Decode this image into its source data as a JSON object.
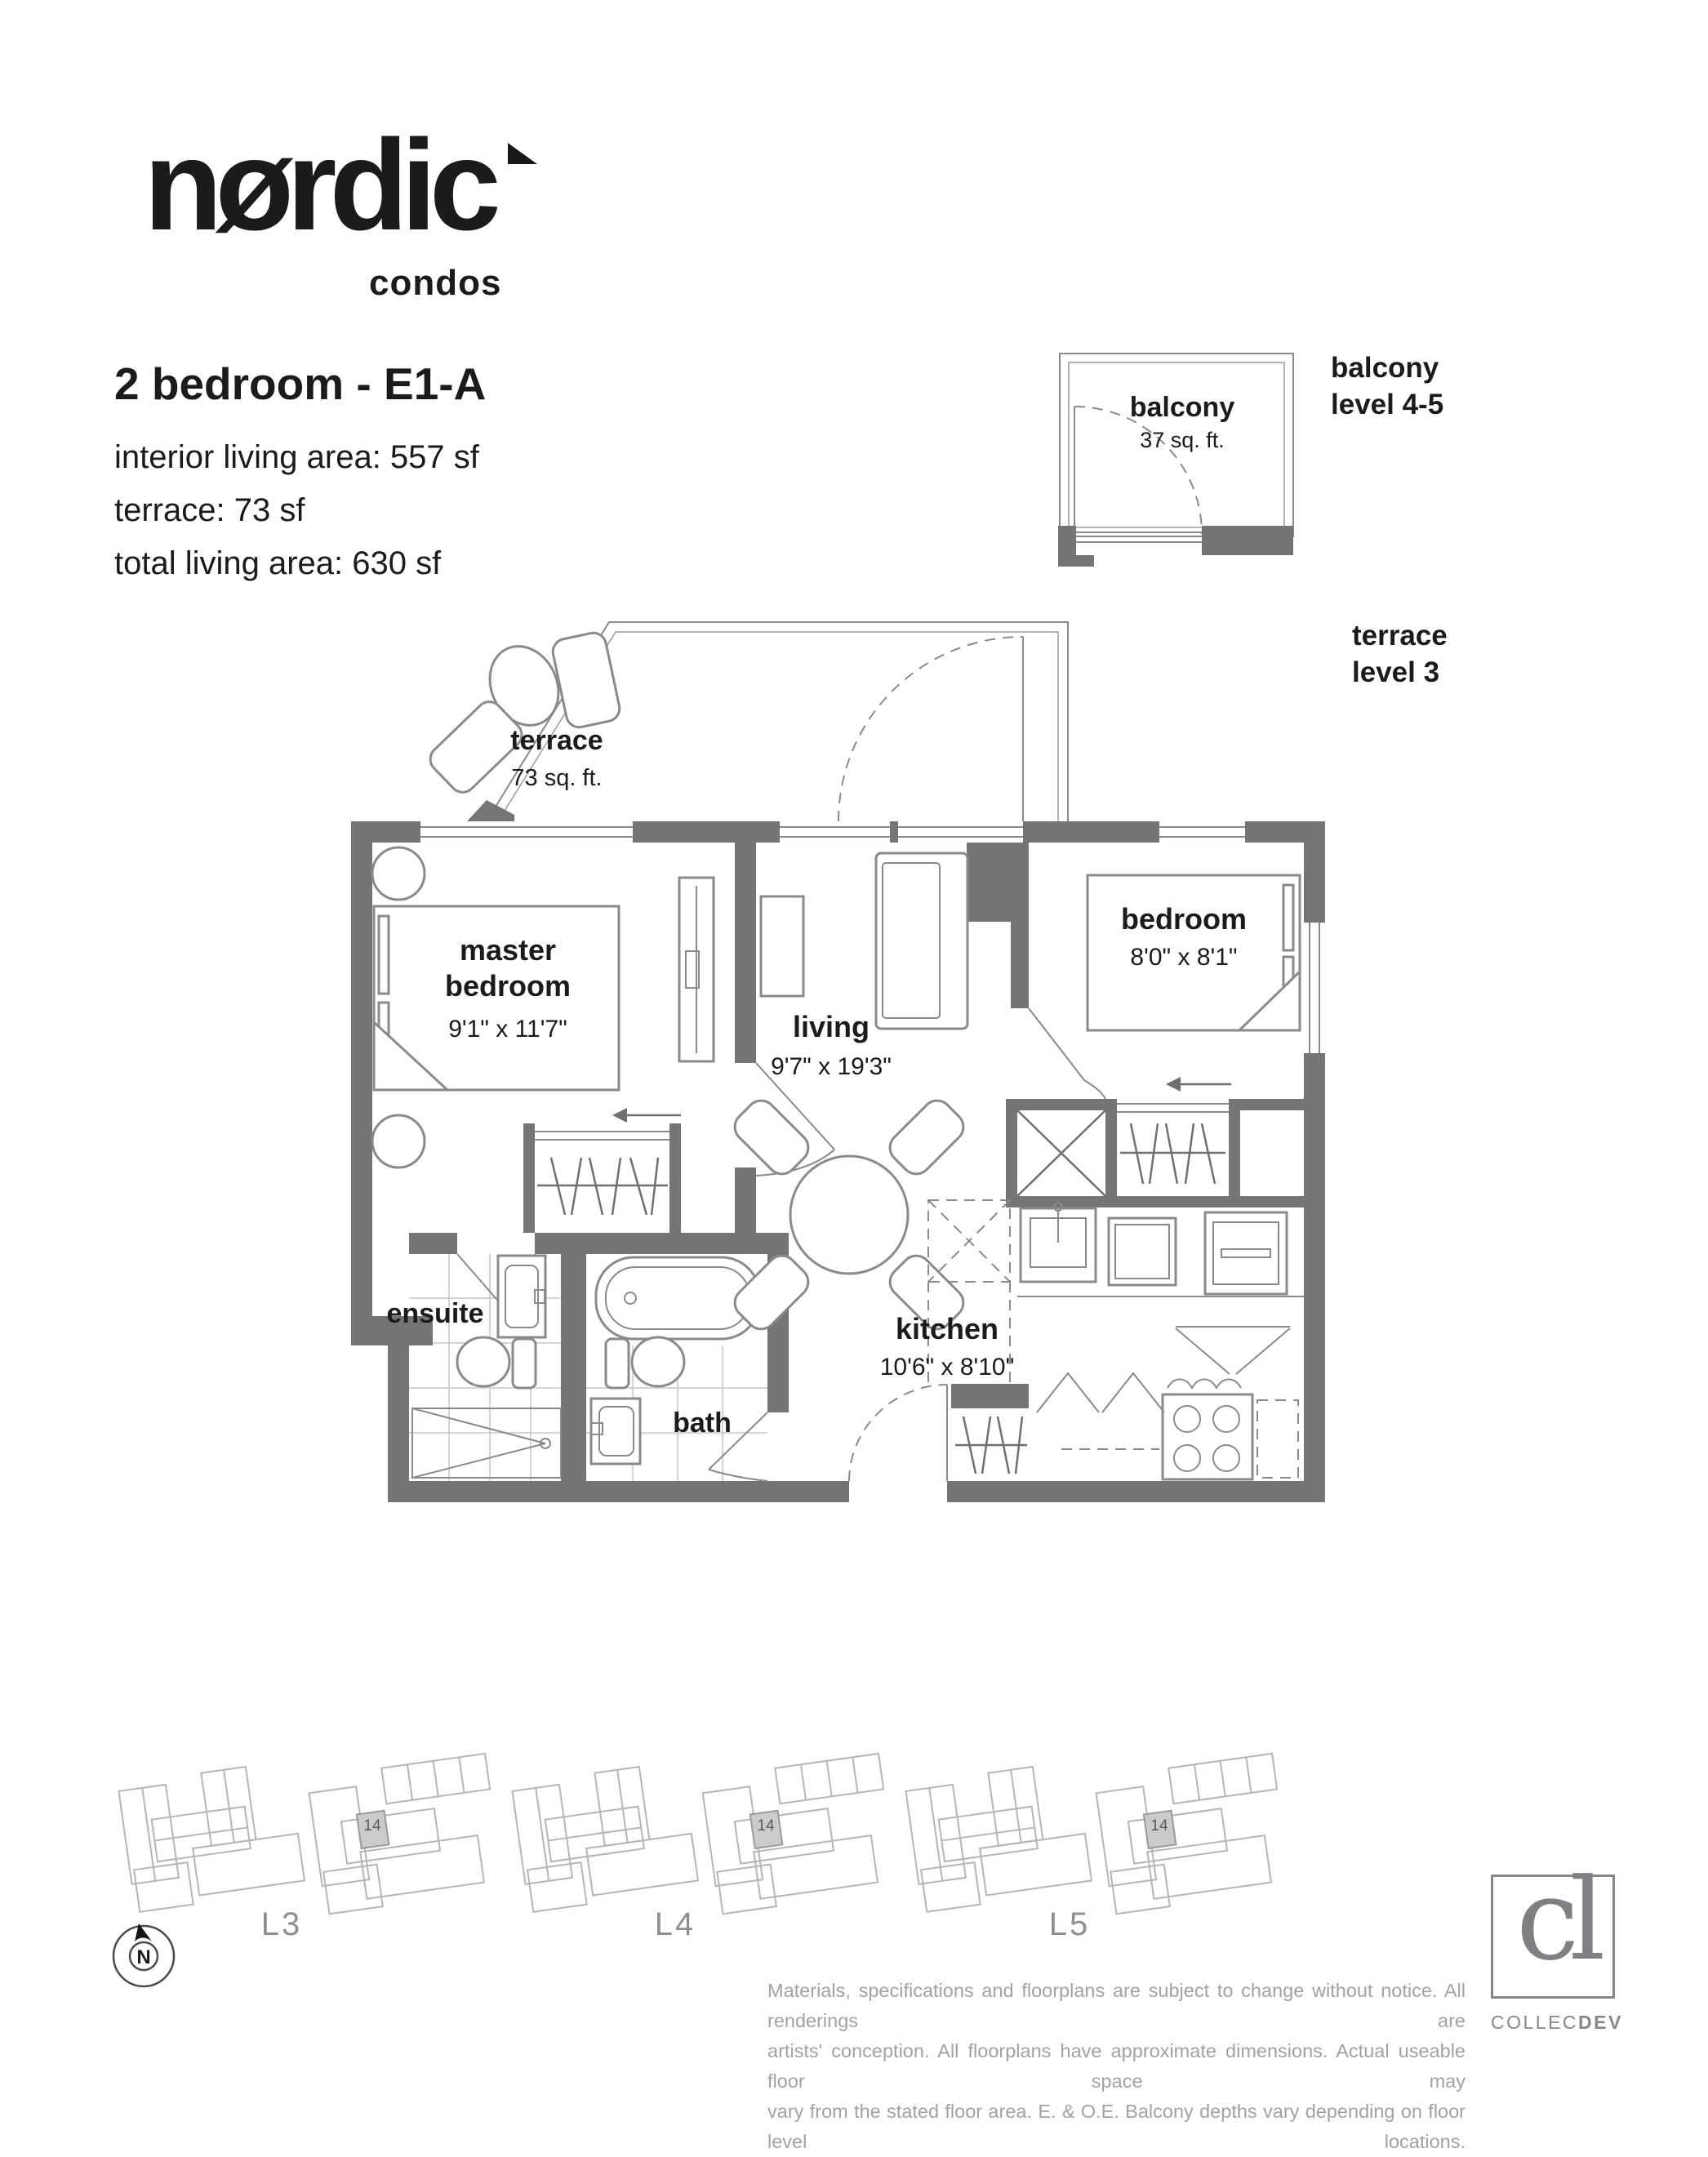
{
  "brand": {
    "logo_text": "nørdic",
    "logo_sub": "condos"
  },
  "header": {
    "title": "2 bedroom - E1-A",
    "area_lines": [
      "interior living area: 557 sf",
      "terrace: 73 sf",
      "total living area: 630 sf"
    ]
  },
  "balcony_inset": {
    "label": "balcony",
    "area": "37 sq. ft.",
    "side_label_line1": "balcony",
    "side_label_line2": "level 4-5"
  },
  "terrace_side_label": {
    "line1": "terrace",
    "line2": "level 3"
  },
  "plan": {
    "rooms": {
      "terrace": {
        "label": "terrace",
        "area": "73 sq. ft."
      },
      "master": {
        "label_line1": "master",
        "label_line2": "bedroom",
        "dims": "9'1\" x 11'7\""
      },
      "bedroom": {
        "label": "bedroom",
        "dims": "8'0\" x 8'1\""
      },
      "living": {
        "label": "living",
        "dims": "9'7\" x 19'3\""
      },
      "kitchen": {
        "label": "kitchen",
        "dims": "10'6\" x 8'10\""
      },
      "ensuite": {
        "label": "ensuite"
      },
      "bath": {
        "label": "bath"
      }
    }
  },
  "keyplans": {
    "items": [
      {
        "label": "L3",
        "unit": "14"
      },
      {
        "label": "L4",
        "unit": "14"
      },
      {
        "label": "L5",
        "unit": "14"
      }
    ]
  },
  "compass": {
    "label": "N"
  },
  "footer": {
    "disclaimer_lines": [
      "Materials, specifications and floorplans are subject to change without notice. All renderings are",
      "artists' conception. All floorplans have approximate dimensions. Actual useable floor space may",
      "vary from the stated floor area. E. & O.E. Balcony depths vary depending on floor level locations."
    ],
    "developer": {
      "monogram": "cl",
      "name_light": "COLLEC",
      "name_bold": "DEV"
    }
  },
  "colors": {
    "wall": "#757575",
    "line": "#8a8a8a",
    "text": "#1b1b1b",
    "tile_line": "#c6c6c6",
    "keyplan_line": "#b5b5b5",
    "muted_text": "#a0a2a5",
    "brand_gray": "#85878a"
  }
}
